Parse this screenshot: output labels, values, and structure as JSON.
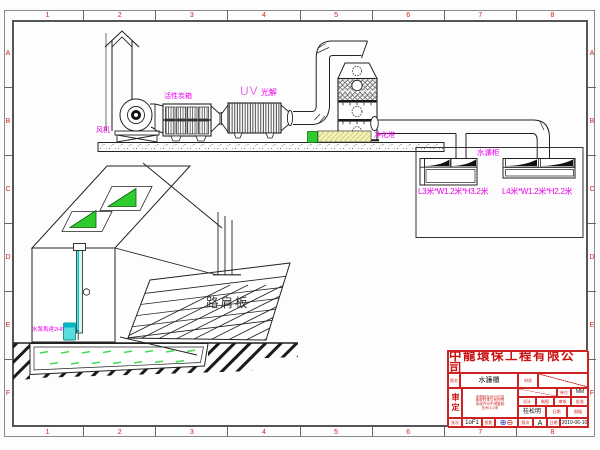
{
  "frame": {
    "cols": [
      "1",
      "2",
      "3",
      "4",
      "5",
      "6",
      "7",
      "8"
    ],
    "rows": [
      "A",
      "B",
      "C",
      "D",
      "E",
      "F"
    ]
  },
  "labels": {
    "fan": "风机",
    "carbon_box": "活性炭箱",
    "uv": "UV",
    "uv_sub": "光解",
    "tower": "净化塔",
    "water_cabinet": "水濂柜",
    "dims_left": "L3米*W1.2米*H3.2米",
    "dims_right": "L4米*W1.2米*H2.2米",
    "walkway": "路肩板",
    "pump": "水泵馬達2HP"
  },
  "colors": {
    "magenta": "#ee00ee",
    "green": "#2ecc2e",
    "cyan": "#00cccc",
    "red": "#cc2222",
    "yellow": "#f4f4bc"
  },
  "title_block": {
    "company": "中龍環保工程有限公司",
    "drawing_name_label": "图名",
    "drawing_name": "水濂櫃",
    "material_label": "材质",
    "approved_label": "审定",
    "note1": "本图纸及设计内容",
    "note2": "版权归本公司所有",
    "note3": "未经许可不得复制",
    "note4": "比例:1/2米",
    "unit_label": "单位",
    "unit": "MM",
    "design_label": "设计",
    "draft_label": "制图",
    "check_label": "审核",
    "approve_label": "批准",
    "designer": "桂松明",
    "date_label": "日期",
    "size_label": "图幅",
    "sheet_label": "张次",
    "sheet": "1oF1",
    "projection_label": "投影",
    "projection_sym1": "⊕",
    "projection_sym2": "⊖",
    "rev_label": "版次",
    "rev": "A",
    "date": "2019-06-10"
  }
}
